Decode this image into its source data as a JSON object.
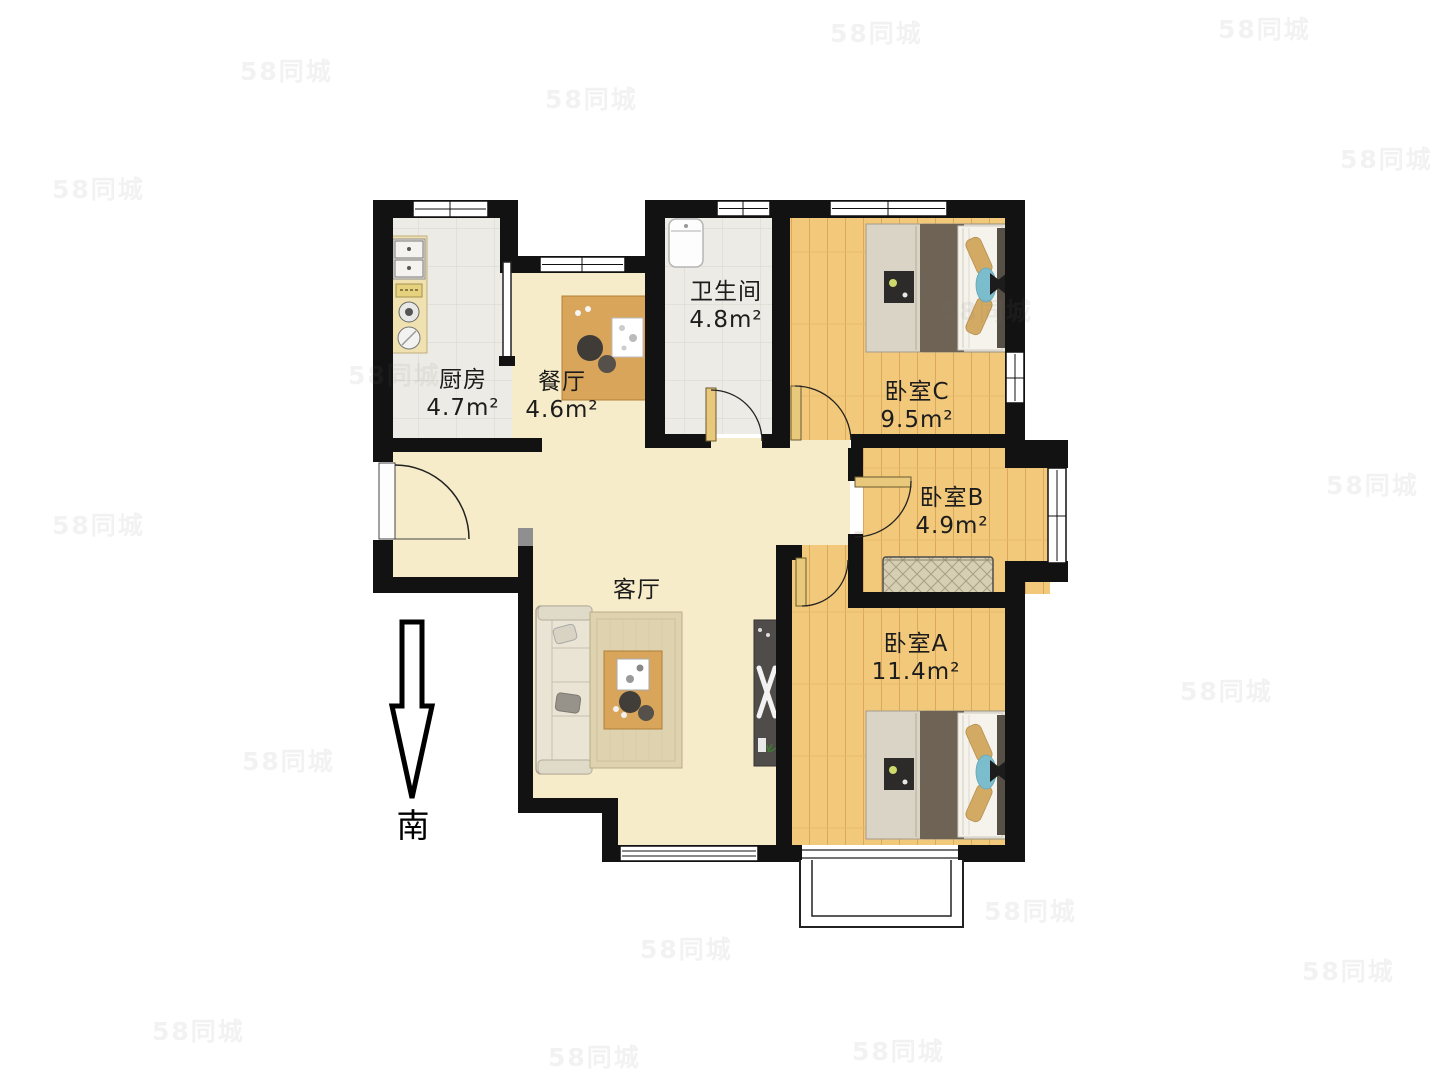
{
  "plan": {
    "rooms": {
      "kitchen": {
        "name": "厨房",
        "area": "4.7m²"
      },
      "dining": {
        "name": "餐厅",
        "area": "4.6m²"
      },
      "bathroom": {
        "name": "卫生间",
        "area": "4.8m²"
      },
      "bedroom_c": {
        "name": "卧室C",
        "area": "9.5m²"
      },
      "bedroom_b": {
        "name": "卧室B",
        "area": "4.9m²"
      },
      "bedroom_a": {
        "name": "卧室A",
        "area": "11.4m²"
      },
      "living": {
        "name": "客厅",
        "area": ""
      }
    },
    "compass": {
      "south_label": "南"
    },
    "watermarks": {
      "site": "58同城",
      "brand": "了家 Jinleju"
    }
  },
  "colors": {
    "wall": "#121212",
    "floor_warm": "#f7ecc9",
    "floor_wood": "#f2c87b",
    "floor_tile": "#edebe5",
    "furniture_wood": "#d8a55b",
    "bed_blanket": "#6f6355",
    "accent_cyan": "#7bbccd",
    "door_leaf": "#e8c87a"
  }
}
